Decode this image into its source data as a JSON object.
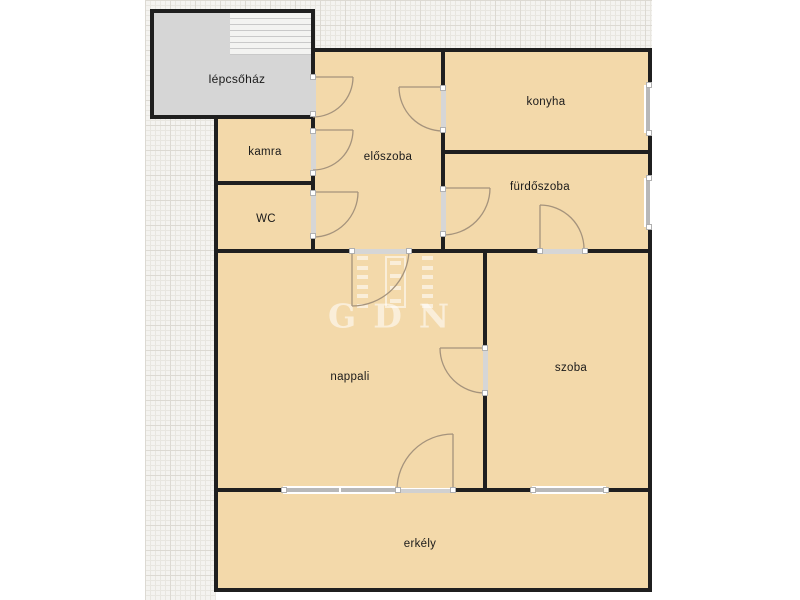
{
  "diagram": {
    "type": "apartment floor plan",
    "watermark_text": "GDN"
  },
  "rooms": [
    {
      "id": "lepcsohaz",
      "label": "lépcsőház"
    },
    {
      "id": "kamra",
      "label": "kamra"
    },
    {
      "id": "wc",
      "label": "WC"
    },
    {
      "id": "eloszoba",
      "label": "előszoba"
    },
    {
      "id": "konyha",
      "label": "konyha"
    },
    {
      "id": "furdoszoba",
      "label": "fürdőszoba"
    },
    {
      "id": "nappali",
      "label": "nappali"
    },
    {
      "id": "szoba",
      "label": "szoba"
    },
    {
      "id": "erkely",
      "label": "erkély"
    }
  ],
  "colors": {
    "wall": "#1f1f1f",
    "room-fill": "#f3d9aa",
    "staircase-fill": "#d6d6d6",
    "stairs-panel": "#f3f3f1",
    "window-glass": "#b8b8b8",
    "door-band": "#d6d6d6",
    "door-arc": "#a5937c",
    "label-text": "#1a1a1a",
    "grid-base": "#f4f3f0",
    "grid-line": "#e8e6e0",
    "grid-strong": "#dcd9d2",
    "watermark": "rgba(255,255,255,0.55)"
  }
}
